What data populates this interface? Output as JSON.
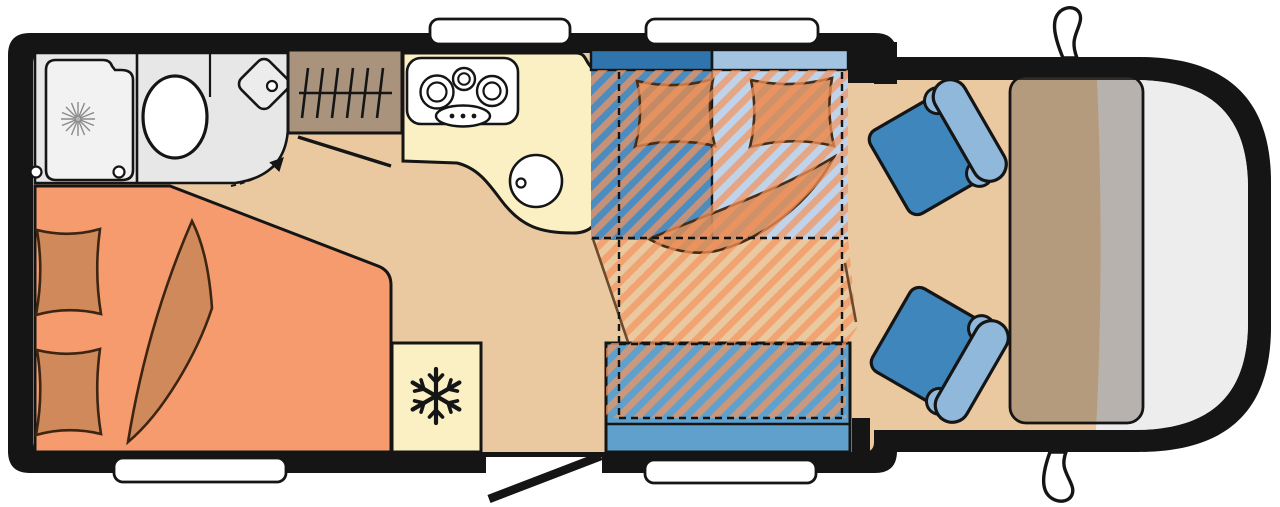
{
  "diagram": {
    "kind": "motorhome-floor-plan",
    "orientation": "rear-left-front-right",
    "regions": [
      {
        "name": "bathroom",
        "features": [
          "shower-tray",
          "shower-drain-icon",
          "toilet",
          "corner-washbasin",
          "door-swing-arc"
        ]
      },
      {
        "name": "wardrobe",
        "features": [
          "hanging-rail-icon"
        ]
      },
      {
        "name": "kitchen",
        "features": [
          "hob-burners-icon",
          "round-sink",
          "faucet-dot"
        ]
      },
      {
        "name": "fridge",
        "features": [
          "snowflake-icon"
        ]
      },
      {
        "name": "rear-bed",
        "features": [
          "pillow",
          "pillow",
          "blanket"
        ]
      },
      {
        "name": "dinette",
        "features": [
          "bench-backrest-dark",
          "bench-backrest-light",
          "mattress",
          "pillow",
          "pillow",
          "blanket",
          "side-bench"
        ]
      },
      {
        "name": "drop-down-bed-overlay",
        "features": [
          "diagonal-hatch",
          "dashed-outline"
        ]
      },
      {
        "name": "cab",
        "features": [
          "swivel-seat-top",
          "swivel-seat-bottom",
          "dashboard",
          "windscreen-area",
          "wing-mirror-top",
          "wing-mirror-bottom"
        ]
      }
    ],
    "windows": [
      "top-kitchen-window",
      "top-dinette-window",
      "bottom-bed-window",
      "bottom-bench-window"
    ],
    "entrance": "open-door-bottom-center"
  },
  "colors": {
    "line": "#151515",
    "floor": "#eac9a0",
    "cabFloor": "#eac9a0",
    "bedOrange": "#f59b6d",
    "cushionTan": "#d0895a",
    "bathGray": "#e7e7e7",
    "trayGray": "#f2f2f2",
    "fixtureWhite": "#ffffff",
    "wardrobeBrown": "#a9937d",
    "kitchenCream": "#fbefc4",
    "seatBackDark": "#2f74ac",
    "seatBodyDark": "#4c8cbe",
    "mattressBlue": "#bfd4ea",
    "mattressBackBlue": "#a3c4e1",
    "benchBlue": "#5fa0cc",
    "stripe": "rgba(244,148,94,0.72)",
    "slantBrown": "#6b4a2e",
    "cabSeatDark": "#3f86bd",
    "cabSeatLight": "#8fb8db",
    "dashboard": "rgba(95,82,68,0.38)",
    "frontWhite": "#ededed",
    "windowWhite": "#ffffff",
    "drainGray": "#8a8a8a"
  }
}
